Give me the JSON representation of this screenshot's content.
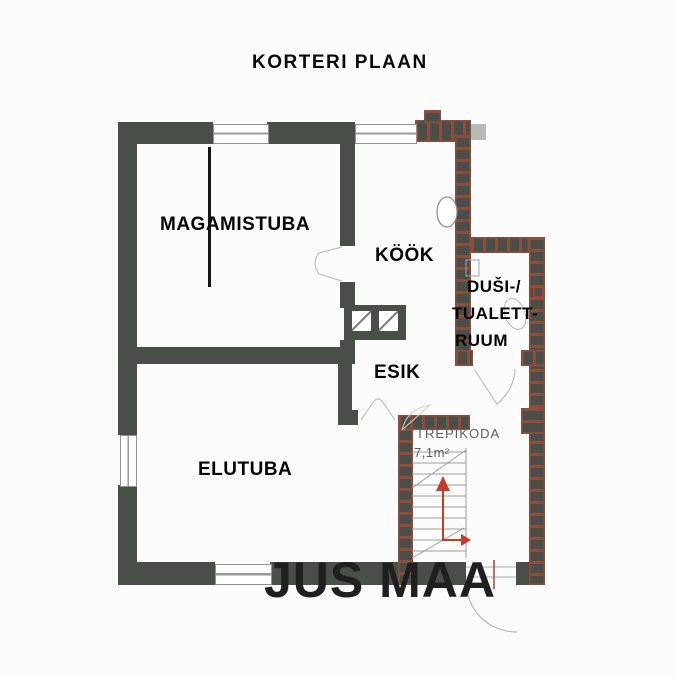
{
  "title": "KORTERI PLAAN",
  "watermark": "JUS MAA",
  "rooms": {
    "bedroom": {
      "label": "MAGAMISTUBA"
    },
    "kitchen": {
      "label": "KÖÖK"
    },
    "bathroom": {
      "line1": "DUŠI-/",
      "line2": "TUALETT-",
      "line3": "RUUM"
    },
    "hallway": {
      "label": "ESIK"
    },
    "living_room": {
      "label": "ELUTUBA"
    },
    "stairwell": {
      "label": "TREPIKODA",
      "area": "7,1m²"
    }
  },
  "colors": {
    "wall": "#4a4e49",
    "renovation_wall_accent": "#8e4d3b",
    "stair_arrow": "#c23b2b",
    "label_text": "#050505",
    "stairwell_text": "#5d5d5d",
    "background": "#fcfcfc"
  }
}
